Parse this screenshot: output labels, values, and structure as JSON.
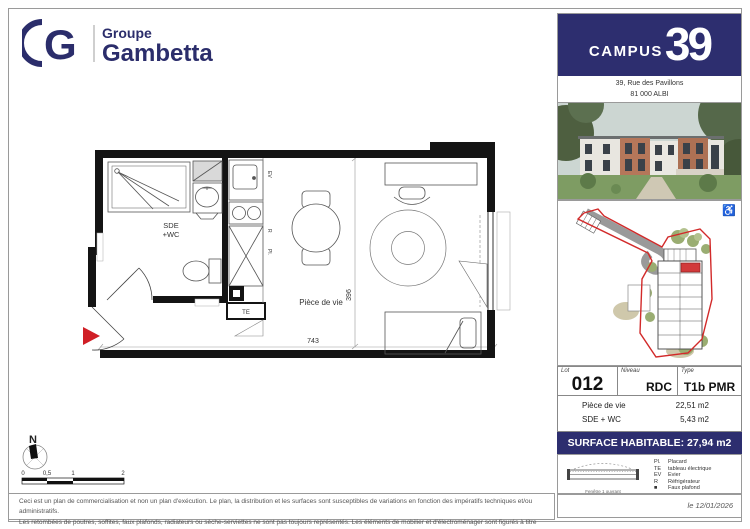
{
  "branding": {
    "monogram": "G",
    "group_line1": "Groupe",
    "group_line2": "Gambetta",
    "brand_navy": "#2b2d6b"
  },
  "project": {
    "name_campus": "CAMPUS",
    "name_number": "39",
    "address_line1": "39, Rue des Pavillons",
    "address_line2": "81 000 ALBI"
  },
  "icons": {
    "accessibility_icon": "♿"
  },
  "plan": {
    "room_sde_line1": "SDE",
    "room_sde_line2": "+WC",
    "room_living_label": "Pièce de vie",
    "dim_width": "743",
    "dim_height": "396",
    "label_te": "TE",
    "label_pl": "Pl.",
    "label_ev": "EV",
    "label_r": "R",
    "entry_arrow_color": "#d01f26"
  },
  "lot": {
    "lot_caption": "Lot",
    "lot_value": "012",
    "level_caption": "Niveau",
    "level_value": "RDC",
    "type_caption": "Type",
    "type_value": "T1b PMR",
    "areas": [
      {
        "name": "Pièce de vie",
        "value": "22,51 m2"
      },
      {
        "name": "SDE + WC",
        "value": "5,43 m2"
      }
    ],
    "surface_label": "SURFACE HABITABLE: 27,94 m2",
    "bar_color": "#2d2e6f"
  },
  "legend": {
    "window_caption": "Fenêtre 1 ouvrant",
    "items": [
      {
        "abbr": "Pl.",
        "label": "Placard"
      },
      {
        "abbr": "TE",
        "label": "tableau électrique"
      },
      {
        "abbr": "EV",
        "label": "Evier"
      },
      {
        "abbr": "R",
        "label": "Réfrigérateur"
      },
      {
        "abbr": "■",
        "label": "Faux plafond"
      }
    ],
    "date": "le 12/01/2026"
  },
  "compass": {
    "north_label": "N"
  },
  "scalebar": {
    "ticks": [
      "0",
      "0,5",
      "1",
      "2"
    ]
  },
  "legal": {
    "line1": "Ceci est un plan de commercialisation et non un plan d'exécution. Le plan, la distribution et les surfaces sont susceptibles de variations en fonction des impératifs techniques et/ou administratifs.",
    "line2": "Les retombées de poutres, soffites, faux plafonds, radiateurs ou sèche-serviettes ne sont pas toujours représentés. Les éléments de mobilier et d'électroménager sont figurés à titre indicatif."
  }
}
